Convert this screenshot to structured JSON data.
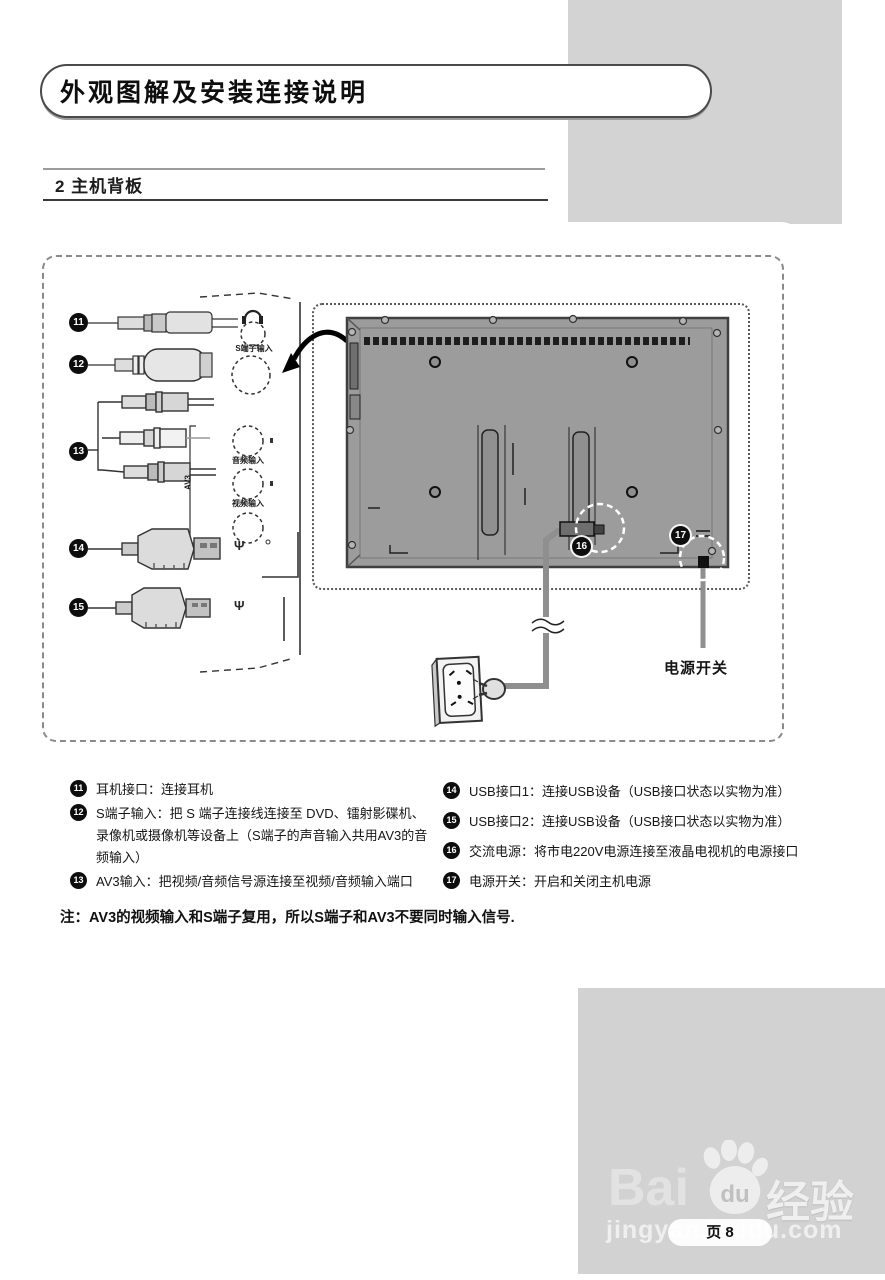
{
  "page": {
    "title": "外观图解及安装连接说明",
    "section_heading": "2 主机背板",
    "note": "注：AV3的视频输入和S端子复用，所以S端子和AV3不要同时输入信号."
  },
  "diagram": {
    "panel_labels": {
      "s_video_in": "S端子输入",
      "audio_in": "音频输入",
      "av3": "AV3",
      "video_in": "视频输入",
      "usb_symbol_1": "Ψ",
      "usb_symbol_2": "Ψ"
    },
    "power_switch_label": "电源开关",
    "badges": {
      "b11": "11",
      "b12": "12",
      "b13": "13",
      "b14": "14",
      "b15": "15",
      "b16": "16",
      "b17": "17"
    }
  },
  "legend": {
    "left": [
      {
        "num": "11",
        "text": "耳机接口：连接耳机"
      },
      {
        "num": "12",
        "text": "S端子输入：把 S 端子连接线连接至 DVD、镭射影碟机、录像机或摄像机等设备上（S端子的声音输入共用AV3的音频输入）"
      },
      {
        "num": "13",
        "text": "AV3输入：把视频/音频信号源连接至视频/音频输入端口"
      }
    ],
    "right": [
      {
        "num": "14",
        "text": "USB接口1：连接USB设备（USB接口状态以实物为准）"
      },
      {
        "num": "15",
        "text": "USB接口2：连接USB设备（USB接口状态以实物为准）"
      },
      {
        "num": "16",
        "text": "交流电源：将市电220V电源连接至液晶电视机的电源接口"
      },
      {
        "num": "17",
        "text": "电源开关：开启和关闭主机电源"
      }
    ]
  },
  "footer": {
    "brand_bai": "Bai",
    "brand_du": "du",
    "brand_jingyan": "经验",
    "url": "jingyan.baidu.com",
    "page_label": "页 8"
  },
  "colors": {
    "gray_band": "#d3d3d3",
    "tv_panel": "#9c9c9c",
    "badge": "#0d0d0d",
    "cable_gray": "#8f8f8f"
  }
}
